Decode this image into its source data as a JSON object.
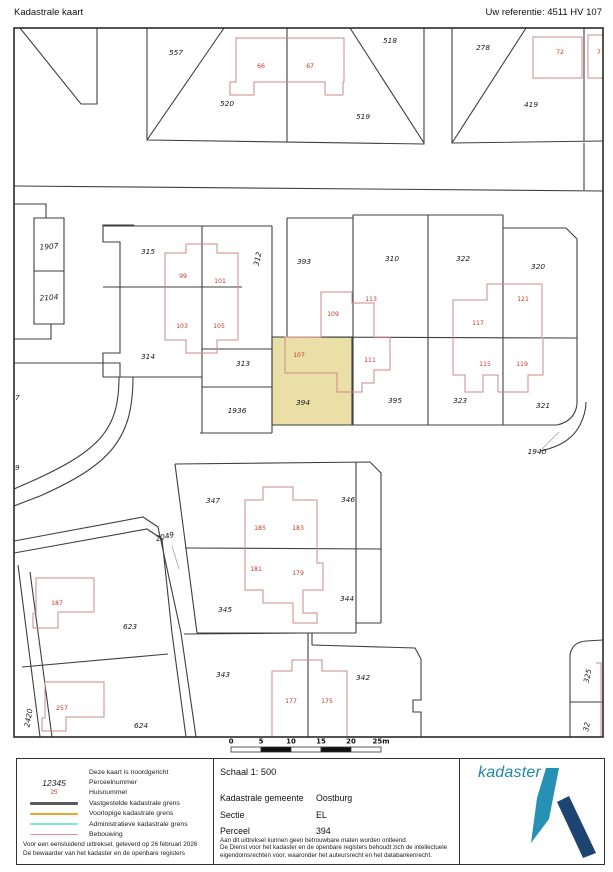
{
  "header": {
    "title": "Kadastrale kaart",
    "reference": "Uw referentie: 4511 HV 107"
  },
  "colors": {
    "boundary": "#3f3f3f",
    "building": "#cf8a8a",
    "house_number": "#c0392b",
    "parcel_text": "#1a1a1a",
    "highlight_fill": "#e9dfa7",
    "leader": "#999999",
    "logo_teal": "#2691b5",
    "logo_navy": "#1e4471",
    "logo_text_color": "#1f86a9"
  },
  "map": {
    "border": {
      "x": 14,
      "y": 28,
      "w": 589,
      "h": 709
    },
    "highlight": {
      "points": "272,337 352,337 352,425 272,425"
    },
    "boundaries": [
      "M20,28 L81,104 L97,104 L97,28",
      "M14,186 L603,191",
      "M147,28 L147,140 L424,144 L424,28",
      "M147,140 L224,28",
      "M287,28 L287,142",
      "M350,28 L424,143",
      "M452,28 L452,143 L603,141",
      "M452,143 L526,28",
      "M584,28 L584,141",
      "M584,143 L584,190",
      "M14,204 L46,204 L46,218",
      "M34,218 L64,218 L64,324 L34,324 Z",
      "M34,271 L64,271",
      "M14,339 L51,339 L51,324",
      "M134,225 L103,225 L103,242 L120,242 L120,353 L103,353 L103,377",
      "M103,226 L272,226",
      "M103,287 L242,287",
      "M103,377 L202,377",
      "M202,226 L202,433",
      "M272,226 L272,433",
      "M202,349 L272,349",
      "M202,387 L272,387",
      "M200,433 L272,433",
      "M287,218 L287,337",
      "M287,218 L353,218",
      "M353,215 L353,425",
      "M353,215 L503,215",
      "M428,215 L428,425",
      "M503,215 L503,425",
      "M503,228 L566,228 L577,239 L577,404",
      "M577,404 Q575,421 557,425",
      "M272,337 L577,338",
      "M272,425 L557,425",
      "M540,451 Q570,445 580,425 Q586,413 586,402",
      "M14,363 L120,363 L120,377",
      "M133,377 C133,438 112,464 40,496 L14,506",
      "M119,377 C119,428 102,450 30,482 L14,489",
      "M175,464 L370,462 L381,473 L381,623",
      "M356,462 L356,633",
      "M185,548 L381,549",
      "M197,633 L356,633",
      "M356,623 L381,623",
      "M175,464 L197,633",
      "M14,541 L143,517 L158,527 L181,633 L196,737",
      "M14,553 L147,529 L162,539 L172,633 L186,737",
      "M22,667 L168,654",
      "M18,565 L40,737",
      "M30,572 L52,737",
      "M184,634 L308,633",
      "M308,633 L308,737",
      "M312,645 L415,648 L421,659 L421,700 L413,700 L413,712 L421,712 L421,737",
      "M312,645 L312,633",
      "M570,737 L570,655 Q572,642 586,641 L603,640",
      "M570,702 L603,702"
    ],
    "buildings": [
      "M236,38 L344,38 L344,82 L343,82 L343,95 L325,95 L325,82 L254,82 L254,95 L230,95 L230,82 L236,82 Z",
      "M533,37 L582,37 L582,78 L533,78 Z",
      "M588,35 L610,35 L610,78 L588,78 Z",
      "M186,244 L217,244 L217,253 L238,253 L238,340 L217,340 L217,353 L186,353 L186,340 L165,340 L165,253 L186,253 Z",
      "M321,292 L352,292 L352,303 L374,303 L374,337 L390,337 L390,370 L374,370 L374,383 L362,383 L362,392 L337,392 L337,373 L285,373 L285,337 L321,337 Z",
      "M453,300 L487,300 L487,284 L542,284 L542,338 L543,338 L543,375 L528,375 L528,392 L498,392 L498,375 L483,375 L483,392 L465,392 L465,375 L453,375 Z",
      "M263,487 L293,487 L293,500 L317,500 L317,563 L323,563 L323,590 L303,590 L303,613 L317,613 L317,623 L293,623 L293,603 L263,603 L263,590 L245,590 L245,500 L263,500 Z",
      "M36,578 L94,578 L94,612 L58,612 L58,628 L33,628 L33,613 L36,613 Z",
      "M45,682 L104,682 L104,717 L66,717 L66,731 L42,731 L42,718 L45,718 Z",
      "M292,660 L322,660 L322,671 L347,671 L347,737 L272,737 L272,671 L292,671 Z",
      "M596,663 L601,663 L601,737"
    ],
    "leaders": [
      "M172,546 L179,569",
      "M542,449 L559,432"
    ],
    "parcel_labels": [
      {
        "t": "557",
        "x": 176,
        "y": 53
      },
      {
        "t": "520",
        "x": 227,
        "y": 104
      },
      {
        "t": "518",
        "x": 390,
        "y": 41
      },
      {
        "t": "519",
        "x": 363,
        "y": 117
      },
      {
        "t": "278",
        "x": 483,
        "y": 48
      },
      {
        "t": "419",
        "x": 531,
        "y": 105
      },
      {
        "t": "1907",
        "x": 49,
        "y": 247,
        "r": -4
      },
      {
        "t": "2104",
        "x": 49,
        "y": 298,
        "r": -4
      },
      {
        "t": "315",
        "x": 148,
        "y": 252
      },
      {
        "t": "314",
        "x": 148,
        "y": 357
      },
      {
        "t": "312",
        "x": 258,
        "y": 259,
        "r": -78
      },
      {
        "t": "313",
        "x": 243,
        "y": 364
      },
      {
        "t": "1936",
        "x": 237,
        "y": 411
      },
      {
        "t": "393",
        "x": 304,
        "y": 262
      },
      {
        "t": "394",
        "x": 303,
        "y": 403
      },
      {
        "t": "310",
        "x": 392,
        "y": 259
      },
      {
        "t": "322",
        "x": 463,
        "y": 259
      },
      {
        "t": "320",
        "x": 538,
        "y": 267
      },
      {
        "t": "395",
        "x": 395,
        "y": 401
      },
      {
        "t": "323",
        "x": 460,
        "y": 401
      },
      {
        "t": "321",
        "x": 543,
        "y": 406
      },
      {
        "t": "1940",
        "x": 537,
        "y": 452
      },
      {
        "t": "347",
        "x": 213,
        "y": 501
      },
      {
        "t": "346",
        "x": 348,
        "y": 500
      },
      {
        "t": "2049",
        "x": 165,
        "y": 537,
        "r": -14
      },
      {
        "t": "345",
        "x": 225,
        "y": 610
      },
      {
        "t": "344",
        "x": 347,
        "y": 599
      },
      {
        "t": "623",
        "x": 130,
        "y": 627
      },
      {
        "t": "624",
        "x": 141,
        "y": 726
      },
      {
        "t": "2420",
        "x": 29,
        "y": 718,
        "r": -80
      },
      {
        "t": "343",
        "x": 223,
        "y": 675
      },
      {
        "t": "342",
        "x": 363,
        "y": 678
      },
      {
        "t": "325",
        "x": 588,
        "y": 676,
        "r": -78
      },
      {
        "t": "32",
        "x": 587,
        "y": 727,
        "r": -78
      },
      {
        "t": "07",
        "x": 15,
        "y": 398
      },
      {
        "t": "09",
        "x": 15,
        "y": 468
      }
    ],
    "house_labels": [
      {
        "t": "66",
        "x": 261,
        "y": 66
      },
      {
        "t": "67",
        "x": 310,
        "y": 66
      },
      {
        "t": "72",
        "x": 560,
        "y": 52
      },
      {
        "t": "7",
        "x": 599,
        "y": 52
      },
      {
        "t": "99",
        "x": 183,
        "y": 276
      },
      {
        "t": "101",
        "x": 220,
        "y": 281
      },
      {
        "t": "103",
        "x": 182,
        "y": 326
      },
      {
        "t": "105",
        "x": 219,
        "y": 326
      },
      {
        "t": "113",
        "x": 371,
        "y": 299
      },
      {
        "t": "109",
        "x": 333,
        "y": 314
      },
      {
        "t": "107",
        "x": 299,
        "y": 355
      },
      {
        "t": "111",
        "x": 370,
        "y": 360
      },
      {
        "t": "121",
        "x": 523,
        "y": 299
      },
      {
        "t": "117",
        "x": 478,
        "y": 323
      },
      {
        "t": "115",
        "x": 485,
        "y": 364
      },
      {
        "t": "119",
        "x": 522,
        "y": 364
      },
      {
        "t": "185",
        "x": 260,
        "y": 528
      },
      {
        "t": "183",
        "x": 298,
        "y": 528
      },
      {
        "t": "181",
        "x": 256,
        "y": 569
      },
      {
        "t": "179",
        "x": 298,
        "y": 573
      },
      {
        "t": "187",
        "x": 57,
        "y": 603
      },
      {
        "t": "257",
        "x": 62,
        "y": 708
      },
      {
        "t": "177",
        "x": 291,
        "y": 701
      },
      {
        "t": "175",
        "x": 327,
        "y": 701
      }
    ]
  },
  "scalebar": {
    "x": 231,
    "y": 747,
    "segment_w": 30,
    "h": 5,
    "labels": [
      "0",
      "5",
      "10",
      "15",
      "20",
      "25m"
    ],
    "fills": [
      "#ffffff",
      "#111111",
      "#ffffff",
      "#111111",
      "#ffffff"
    ]
  },
  "legend": {
    "rows": [
      {
        "kind": "none",
        "sample": "",
        "color": "",
        "label": "Deze kaart is noordgericht"
      },
      {
        "kind": "text",
        "sample": "12345",
        "color": "#222222",
        "label": "Perceelnummer"
      },
      {
        "kind": "redtext",
        "sample": "25",
        "color": "#c0392b",
        "label": "Huisnummer"
      },
      {
        "kind": "line",
        "sample": "",
        "color": "#5a5a5a",
        "label": "Vastgestelde kadastrale grens"
      },
      {
        "kind": "line",
        "sample": "",
        "color": "#e3a72f",
        "label": "Voorlopige kadastrale grens"
      },
      {
        "kind": "line",
        "sample": "",
        "color": "#7de9cd",
        "label": "Administratieve kadastrale grens"
      },
      {
        "kind": "line",
        "sample": "",
        "color": "#e88f8f",
        "label": "Bebouwing"
      }
    ],
    "footer_line1": "Voor een eensluidend uittreksel, geleverd op 26 februari 2026",
    "footer_line2": "De bewaarder van het kadaster en de openbare registers",
    "schaal": "Schaal 1: 500",
    "fields": [
      {
        "label": "Kadastrale gemeente",
        "value": "Oostburg"
      },
      {
        "label": "Sectie",
        "value": "EL"
      },
      {
        "label": "Perceel",
        "value": "394"
      }
    ],
    "disclaimer_lines": [
      "Aan dit uittreksel kunnen geen betrouwbare maten worden ontleend.",
      "De Dienst voor het kadaster en de openbare registers behoudt zich de intellectuele",
      "eigendomsrechten voor, waaronder het auteursrecht en het databankenrecht."
    ],
    "logo_text": "kadaster",
    "logo_teal_points": "546,767 559,767 549,818 531,842 537,797",
    "logo_navy_points": "557,801 569,795 596,852 583,857"
  }
}
